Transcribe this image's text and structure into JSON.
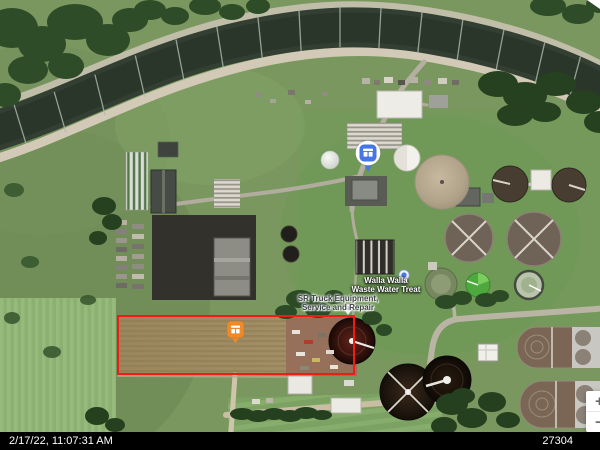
{
  "status_bar": {
    "timestamp": "2/17/22, 11:07:31 AM",
    "frame_counter": "27304"
  },
  "map": {
    "view": "satellite",
    "poi_labels": {
      "wwtp": {
        "line1": "Walla Walla",
        "line2": "Waste Water Treat"
      },
      "sr_truck": {
        "line1": "SR Truck Equipment,",
        "line2": "Service and Repair"
      }
    },
    "markers": {
      "field_marker": {
        "type": "orange-square-pin",
        "icon": "storefront-icon",
        "color": "#ec8b2d"
      },
      "wwtp_marker": {
        "type": "blue-circle-pin",
        "icon": "storefront-icon",
        "color": "#4576e6"
      },
      "wwtp_small_pin": {
        "type": "teardrop-pin",
        "color": "#4a7ae0"
      },
      "sr_truck_pin": {
        "type": "dot-pin",
        "color": "#9aa0a6"
      }
    },
    "highlight_box": {
      "color": "#ee1c14"
    },
    "zoom_control": {
      "zoom_in_label": "+",
      "zoom_out_label": "−"
    }
  }
}
